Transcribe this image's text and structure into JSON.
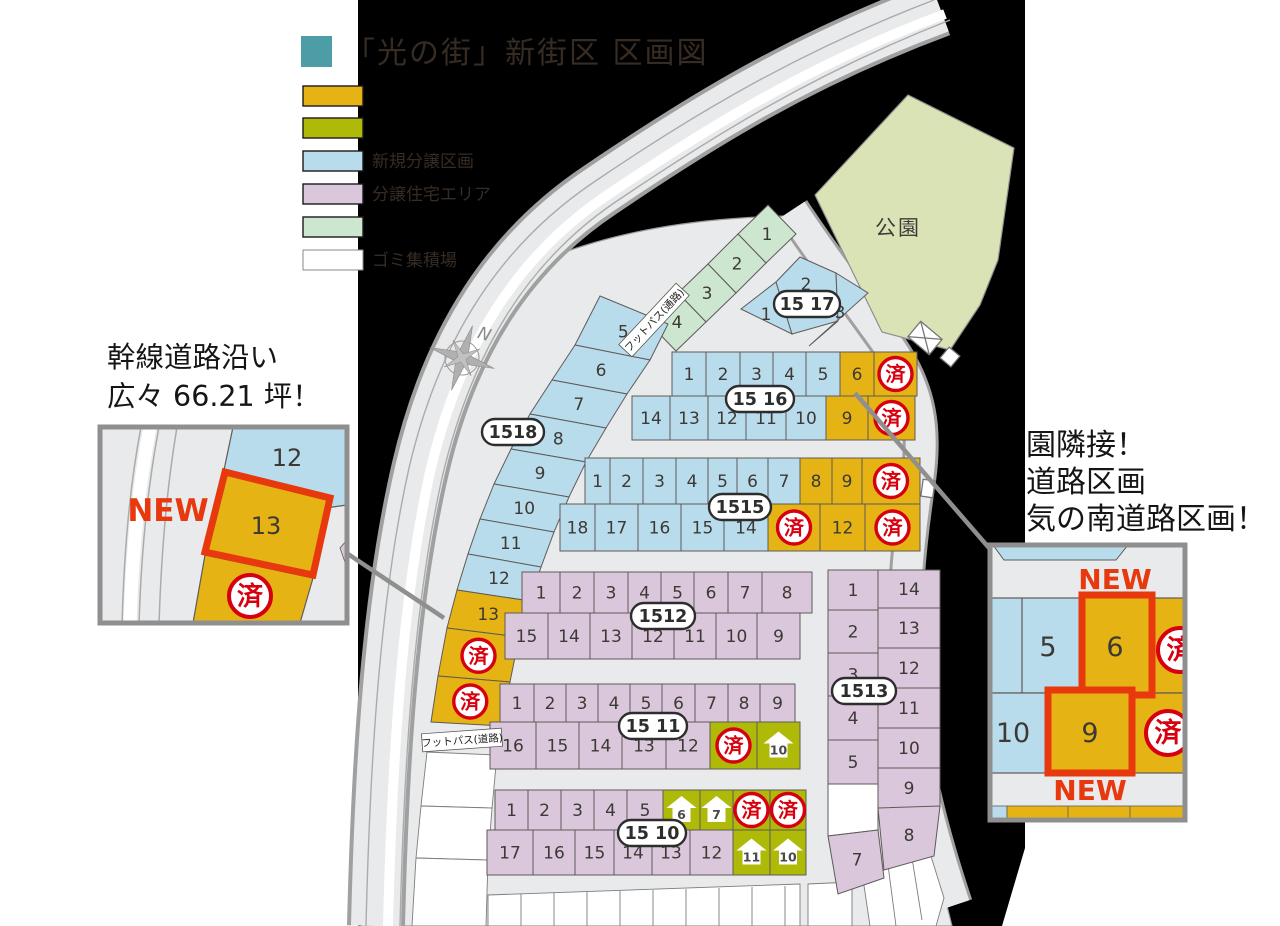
{
  "title": {
    "text": "「光の街」新街区 区画図",
    "accent_color": "#4d9da6"
  },
  "legend": {
    "items": [
      {
        "label": "",
        "color": "#e5b414"
      },
      {
        "label": "",
        "color": "#afba08"
      },
      {
        "label": "新規分譲区画",
        "color": "#b9dcec"
      },
      {
        "label": "分譲住宅エリア",
        "color": "#dac7db"
      },
      {
        "label": "",
        "color": "#cde6cf"
      },
      {
        "label": "ゴミ集積場",
        "color": "#ffffff"
      }
    ]
  },
  "callout_left": {
    "title_line1": "幹線道路沿い",
    "title_line2": "広々 66.21 坪！",
    "new_label": "NEW",
    "back_lot": "12",
    "featured_lot": "13",
    "sold_mark": "済"
  },
  "callout_right": {
    "caption_lines": [
      "園隣接！",
      "道路区画",
      "気の南道路区画！"
    ],
    "new_label_top": "NEW",
    "new_label_bottom": "NEW",
    "lots": {
      "blue_top": "5",
      "featured_top": "6",
      "blue_bottom": "10",
      "featured_bottom": "9"
    },
    "sold_mark": "済"
  },
  "map": {
    "park_label": "公園",
    "footpath_path_label": "フットパス(通路)",
    "footpath_road_label": "フットパス(道路)",
    "sold_mark": "済",
    "compass_letter": "N",
    "colors": {
      "gold": "#e5b414",
      "yellow_green": "#afba08",
      "blue": "#b9dcec",
      "purple": "#dac7db",
      "green": "#cde6cf",
      "park": "#dae3b5",
      "sold_red": "#d7000f",
      "new_red": "#e8380d",
      "road": "#e9eaeb"
    },
    "blocks": [
      {
        "id": "green",
        "pill": "",
        "cells": [
          {
            "v": "1",
            "c": "green"
          },
          {
            "v": "2",
            "c": "green"
          },
          {
            "v": "3",
            "c": "green"
          },
          {
            "v": "4",
            "c": "green"
          }
        ]
      },
      {
        "id": "b1517",
        "pill": "15 17",
        "cells": [
          {
            "v": "1",
            "c": "blue"
          },
          {
            "v": "2",
            "c": "blue"
          },
          {
            "v": "3",
            "c": "blue"
          }
        ]
      },
      {
        "id": "b1518",
        "pill": "1518",
        "cells": [
          {
            "v": "5",
            "c": "blue"
          },
          {
            "v": "6",
            "c": "blue"
          },
          {
            "v": "7",
            "c": "blue"
          },
          {
            "v": "8",
            "c": "blue"
          },
          {
            "v": "9",
            "c": "blue"
          },
          {
            "v": "10",
            "c": "blue"
          },
          {
            "v": "11",
            "c": "blue"
          },
          {
            "v": "12",
            "c": "blue"
          },
          {
            "v": "13",
            "c": "gold"
          },
          {
            "sold": true,
            "c": "gold"
          },
          {
            "sold": true,
            "c": "gold"
          }
        ]
      },
      {
        "id": "b1516",
        "pill": "15 16",
        "rows": [
          [
            {
              "v": "1",
              "c": "blue"
            },
            {
              "v": "2",
              "c": "blue"
            },
            {
              "v": "3",
              "c": "blue"
            },
            {
              "v": "4",
              "c": "blue"
            },
            {
              "v": "5",
              "c": "blue"
            },
            {
              "v": "6",
              "c": "gold"
            },
            {
              "sold": true,
              "c": "gold"
            }
          ],
          [
            {
              "v": "14",
              "c": "blue"
            },
            {
              "v": "13",
              "c": "blue"
            },
            {
              "v": "12",
              "c": "blue"
            },
            {
              "v": "11",
              "c": "blue"
            },
            {
              "v": "10",
              "c": "blue"
            },
            {
              "v": "9",
              "c": "gold"
            },
            {
              "sold": true,
              "c": "gold"
            }
          ]
        ]
      },
      {
        "id": "b1515",
        "pill": "1515",
        "rows": [
          [
            {
              "v": "1",
              "c": "blue"
            },
            {
              "v": "2",
              "c": "blue"
            },
            {
              "v": "3",
              "c": "blue"
            },
            {
              "v": "4",
              "c": "blue"
            },
            {
              "v": "5",
              "c": "blue"
            },
            {
              "v": "6",
              "c": "blue"
            },
            {
              "v": "7",
              "c": "blue"
            },
            {
              "v": "8",
              "c": "gold"
            },
            {
              "v": "9",
              "c": "gold"
            },
            {
              "sold": true,
              "c": "gold"
            }
          ],
          [
            {
              "v": "18",
              "c": "blue"
            },
            {
              "v": "17",
              "c": "blue"
            },
            {
              "v": "16",
              "c": "blue"
            },
            {
              "v": "15",
              "c": "blue"
            },
            {
              "v": "14",
              "c": "blue"
            },
            {
              "sold": true,
              "c": "gold"
            },
            {
              "v": "12",
              "c": "gold"
            },
            {
              "sold": true,
              "c": "gold"
            }
          ]
        ]
      },
      {
        "id": "b1512",
        "pill": "1512",
        "rows": [
          [
            {
              "v": "1",
              "c": "purple"
            },
            {
              "v": "2",
              "c": "purple"
            },
            {
              "v": "3",
              "c": "purple"
            },
            {
              "v": "4",
              "c": "purple"
            },
            {
              "v": "5",
              "c": "purple"
            },
            {
              "v": "6",
              "c": "purple"
            },
            {
              "v": "7",
              "c": "purple"
            },
            {
              "v": "8",
              "c": "purple"
            }
          ],
          [
            {
              "v": "15",
              "c": "purple"
            },
            {
              "v": "14",
              "c": "purple"
            },
            {
              "v": "13",
              "c": "purple"
            },
            {
              "v": "12",
              "c": "purple"
            },
            {
              "v": "11",
              "c": "purple"
            },
            {
              "v": "10",
              "c": "purple"
            },
            {
              "v": "9",
              "c": "purple"
            }
          ]
        ]
      },
      {
        "id": "b1511",
        "pill": "15 11",
        "rows": [
          [
            {
              "v": "1",
              "c": "purple"
            },
            {
              "v": "2",
              "c": "purple"
            },
            {
              "v": "3",
              "c": "purple"
            },
            {
              "v": "4",
              "c": "purple"
            },
            {
              "v": "5",
              "c": "purple"
            },
            {
              "v": "6",
              "c": "purple"
            },
            {
              "v": "7",
              "c": "purple"
            },
            {
              "v": "8",
              "c": "purple"
            },
            {
              "v": "9",
              "c": "purple"
            }
          ],
          [
            {
              "v": "16",
              "c": "purple"
            },
            {
              "v": "15",
              "c": "purple"
            },
            {
              "v": "14",
              "c": "purple"
            },
            {
              "v": "13",
              "c": "purple"
            },
            {
              "v": "12",
              "c": "purple"
            },
            {
              "sold": true,
              "c": "yg"
            },
            {
              "v": "10",
              "c": "yg",
              "house": true
            }
          ]
        ]
      },
      {
        "id": "b1510",
        "pill": "15 10",
        "rows": [
          [
            {
              "v": "1",
              "c": "purple"
            },
            {
              "v": "2",
              "c": "purple"
            },
            {
              "v": "3",
              "c": "purple"
            },
            {
              "v": "4",
              "c": "purple"
            },
            {
              "v": "5",
              "c": "purple"
            },
            {
              "v": "6",
              "c": "yg",
              "house": true
            },
            {
              "v": "7",
              "c": "yg",
              "house": true
            },
            {
              "sold": true,
              "c": "yg"
            },
            {
              "sold": true,
              "c": "yg"
            }
          ],
          [
            {
              "v": "17",
              "c": "purple"
            },
            {
              "v": "16",
              "c": "purple"
            },
            {
              "v": "15",
              "c": "purple"
            },
            {
              "v": "14",
              "c": "purple"
            },
            {
              "v": "13",
              "c": "purple"
            },
            {
              "v": "12",
              "c": "purple"
            },
            {
              "v": "11",
              "c": "yg",
              "house": true
            },
            {
              "v": "10",
              "c": "yg",
              "house": true
            }
          ]
        ]
      },
      {
        "id": "b1513",
        "pill": "1513",
        "cols": [
          [
            {
              "v": "1",
              "c": "purple"
            },
            {
              "v": "2",
              "c": "purple"
            },
            {
              "v": "3",
              "c": "purple"
            },
            {
              "v": "4",
              "c": "purple"
            },
            {
              "v": "5",
              "c": "purple"
            }
          ],
          [
            {
              "v": "14",
              "c": "purple"
            },
            {
              "v": "13",
              "c": "purple"
            },
            {
              "v": "12",
              "c": "purple"
            },
            {
              "v": "11",
              "c": "purple"
            },
            {
              "v": "10",
              "c": "purple"
            },
            {
              "v": "9",
              "c": "purple"
            }
          ]
        ],
        "extras": [
          {
            "c": "white"
          },
          {
            "v": "7",
            "c": "purple"
          },
          {
            "v": "8",
            "c": "purple"
          }
        ]
      }
    ]
  }
}
